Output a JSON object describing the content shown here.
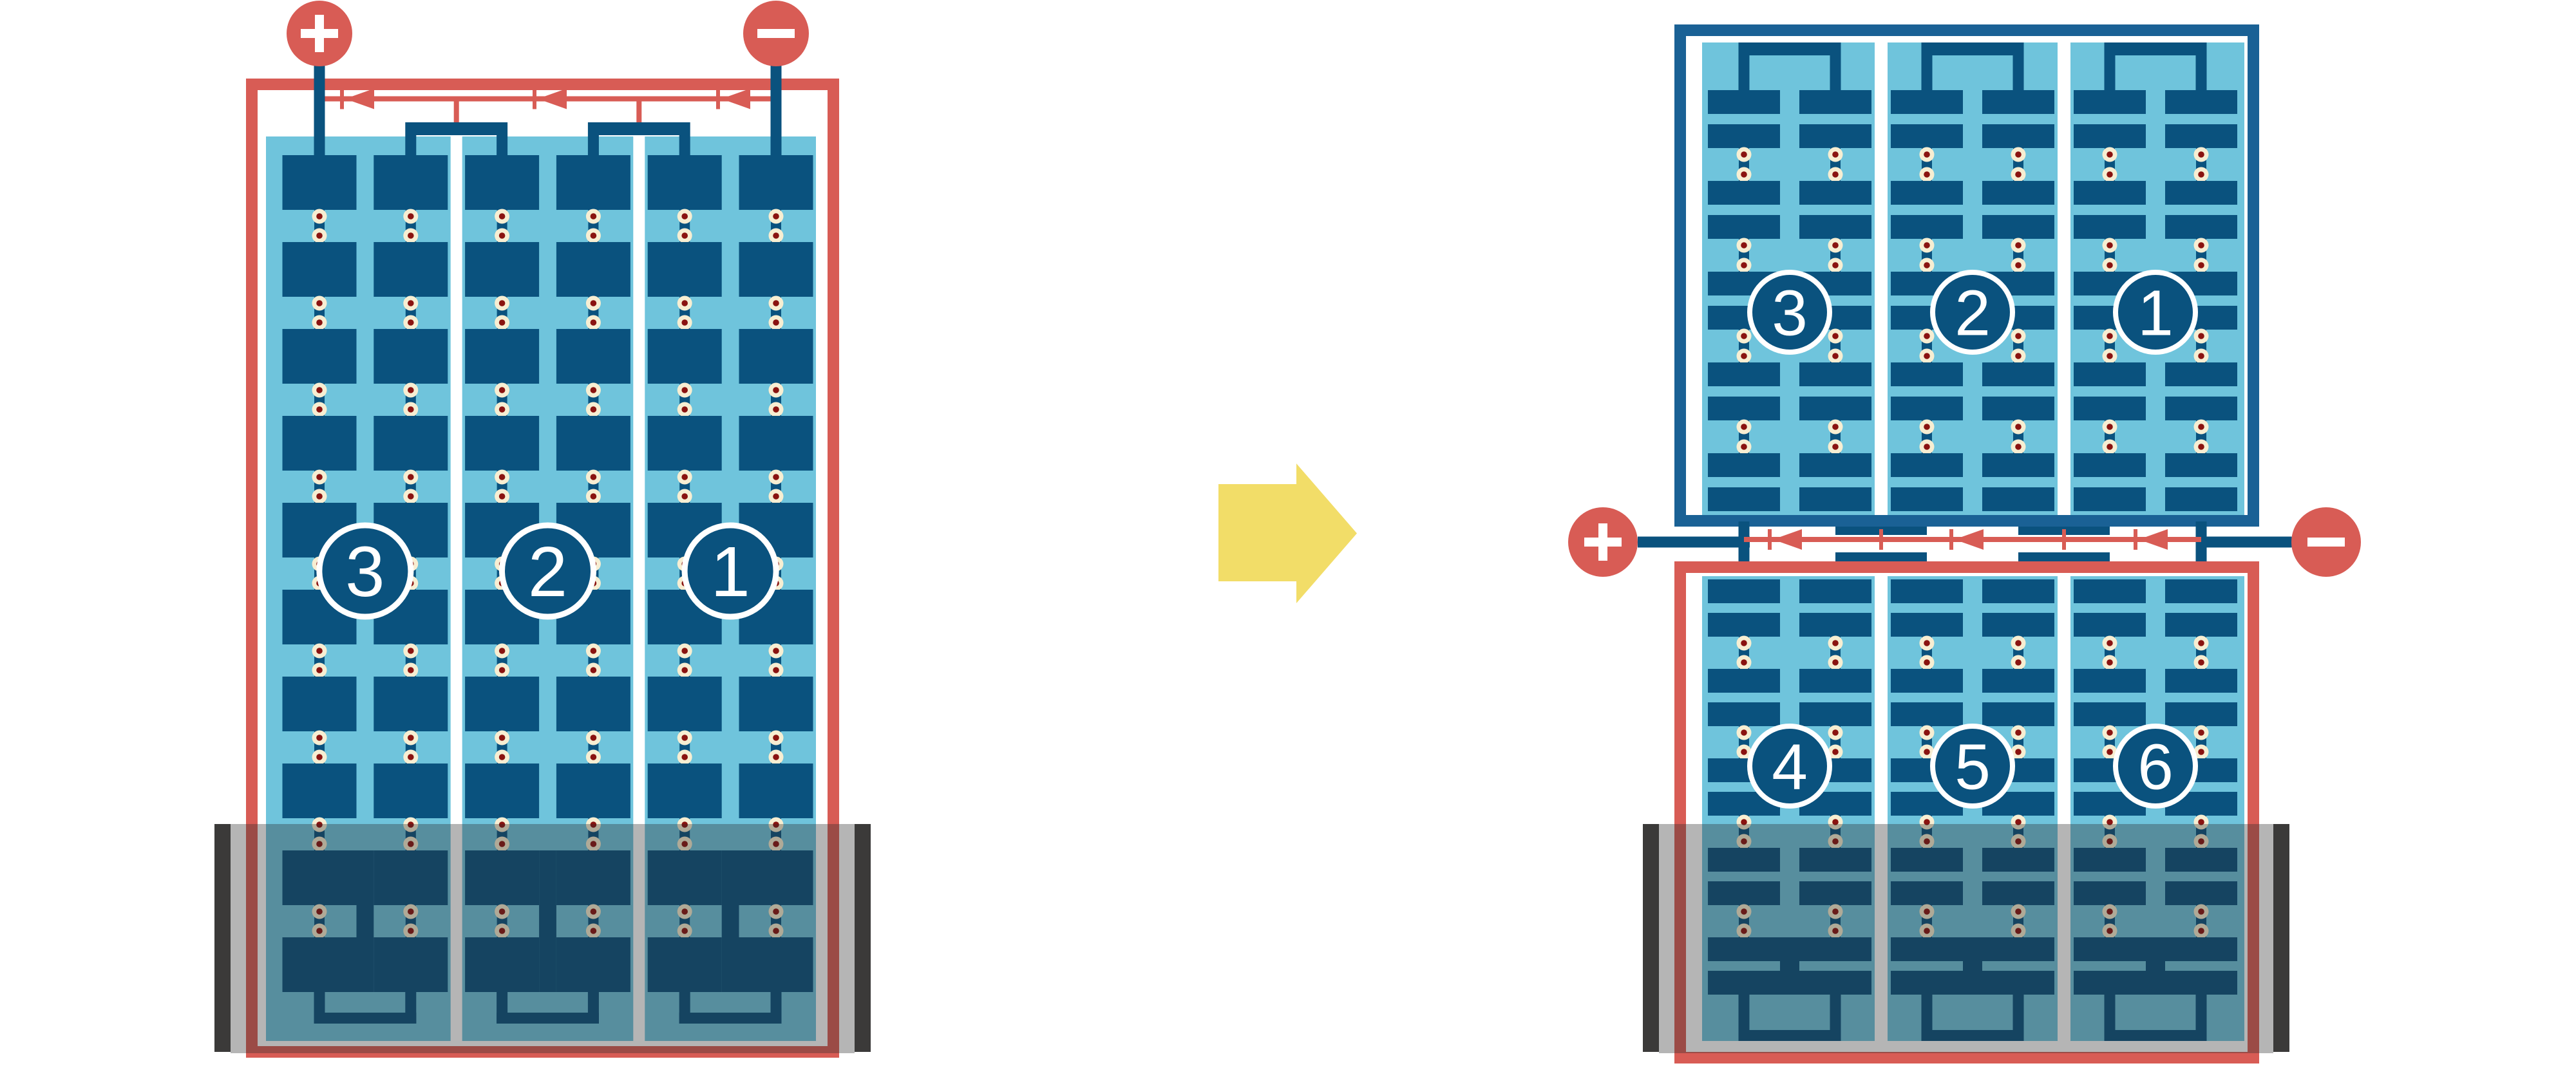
{
  "colors": {
    "module_red": "#d85c55",
    "frame_blue": "#1a6195",
    "cell_navy": "#0a527e",
    "panel_blue": "#6fc4dc",
    "rivet_cream": "#f7eed2",
    "rivet_core_red": "#8a1310",
    "arrow_yellow": "#f2dd68",
    "shade_gray": "#2a2a2a",
    "shade_opacity": "0.35",
    "shade_bar_dark": "#3b3a39",
    "background": "#ffffff",
    "number_text": "#ffffff"
  },
  "left_module": {
    "string_labels": [
      "3",
      "2",
      "1"
    ],
    "columns": 3,
    "rows": 10,
    "bypass_diodes": 3,
    "terminals": {
      "positive_icon": "plus",
      "negative_icon": "minus"
    }
  },
  "flow_arrow": {
    "icon": "arrow-right"
  },
  "right_assembly": {
    "top_module": {
      "string_labels": [
        "3",
        "2",
        "1"
      ],
      "columns": 3,
      "row_pairs": 5
    },
    "junction": {
      "bypass_diodes": 3,
      "terminals": {
        "positive_icon": "plus",
        "negative_icon": "minus"
      }
    },
    "bottom_module": {
      "string_labels": [
        "4",
        "5",
        "6"
      ],
      "columns": 3,
      "row_pairs": 5
    }
  },
  "shade": {
    "present": true,
    "position": "bottom"
  }
}
